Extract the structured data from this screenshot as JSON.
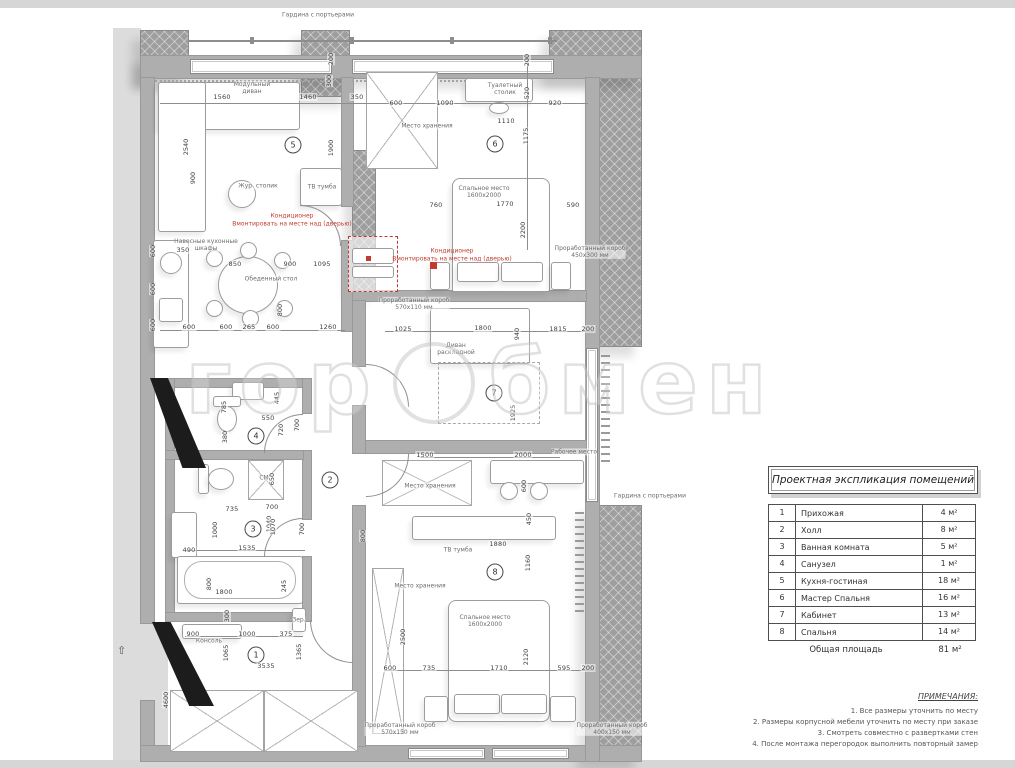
{
  "watermark": {
    "part1": "гор",
    "part2": "бмен"
  },
  "legend": {
    "title": "Проектная экспликация помещений",
    "rows": [
      {
        "num": "1",
        "name": "Прихожая",
        "area": "4 м²"
      },
      {
        "num": "2",
        "name": "Холл",
        "area": "8 м²"
      },
      {
        "num": "3",
        "name": "Ванная комната",
        "area": "5 м²"
      },
      {
        "num": "4",
        "name": "Санузел",
        "area": "1 м²"
      },
      {
        "num": "5",
        "name": "Кухня-гостиная",
        "area": "18 м²"
      },
      {
        "num": "6",
        "name": "Мастер Спальня",
        "area": "16 м²"
      },
      {
        "num": "7",
        "name": "Кабинет",
        "area": "13 м²"
      },
      {
        "num": "8",
        "name": "Спальня",
        "area": "14 м²"
      }
    ],
    "total_label": "Общая площадь",
    "total_area": "81 м²"
  },
  "notes": {
    "heading": "ПРИМЕЧАНИЯ:",
    "items": [
      "1. Все размеры уточнить по месту",
      "2. Размеры корпусной мебели уточнить по месту при заказе",
      "3. Смотреть совместно с развертками стен",
      "4. После монтажа перегородок выполнить повторный замер"
    ]
  },
  "plan": {
    "colors": {
      "wall": "#aeaeae",
      "hatch": "#9e9e9e",
      "dim_text": "#3f3f3f",
      "label_text": "#6c6c6c",
      "red": "#c23b2e"
    },
    "labels": [
      {
        "t": "Гардина с портьерами",
        "x": 318,
        "y": 15,
        "c": "name"
      },
      {
        "t": "Модульный\nдиван",
        "x": 252,
        "y": 88,
        "c": "name"
      },
      {
        "t": "Жур. столик",
        "x": 258,
        "y": 186,
        "c": "name"
      },
      {
        "t": "ТВ тумба",
        "x": 322,
        "y": 187,
        "c": "name"
      },
      {
        "t": "Туалетный\nстолик",
        "x": 505,
        "y": 89,
        "c": "name"
      },
      {
        "t": "Место хранения",
        "x": 427,
        "y": 126,
        "c": "name"
      },
      {
        "t": "Спальное место\n1600х2000",
        "x": 484,
        "y": 192,
        "c": "name"
      },
      {
        "t": "Навесные кухонные\nшкафы",
        "x": 206,
        "y": 245,
        "c": "name"
      },
      {
        "t": "Обеденный стол",
        "x": 271,
        "y": 279,
        "c": "name"
      },
      {
        "t": "Диван\nраскладной",
        "x": 456,
        "y": 349,
        "c": "name"
      },
      {
        "t": "Проработанный короб\n570х110 мм",
        "x": 414,
        "y": 304,
        "c": "name"
      },
      {
        "t": "Проработанный короб\n450х300 мм",
        "x": 590,
        "y": 252,
        "c": "name"
      },
      {
        "t": "Место хранения",
        "x": 430,
        "y": 486,
        "c": "name"
      },
      {
        "t": "Рабочее место",
        "x": 574,
        "y": 452,
        "c": "name"
      },
      {
        "t": "ТВ тумба",
        "x": 458,
        "y": 550,
        "c": "name"
      },
      {
        "t": "Место хранения",
        "x": 420,
        "y": 586,
        "c": "name"
      },
      {
        "t": "Спальное место\n1600х2000",
        "x": 485,
        "y": 621,
        "c": "name"
      },
      {
        "t": "Гардина с портьерами",
        "x": 650,
        "y": 496,
        "c": "name"
      },
      {
        "t": "Консоль",
        "x": 209,
        "y": 641,
        "c": "name"
      },
      {
        "t": "Зер.",
        "x": 299,
        "y": 620,
        "c": "name"
      },
      {
        "t": "СМ",
        "x": 264,
        "y": 478,
        "c": "name"
      },
      {
        "t": "Проработанный короб\n570х150 мм",
        "x": 400,
        "y": 729,
        "c": "name"
      },
      {
        "t": "Проработанный короб\n400х150 мм",
        "x": 612,
        "y": 729,
        "c": "name"
      },
      {
        "t": "Кондиционер\nВмонтировать на месте над (дверью)",
        "x": 292,
        "y": 220,
        "c": "red"
      },
      {
        "t": "Кондиционер\nВмонтировать на месте над (дверью)",
        "x": 452,
        "y": 255,
        "c": "red"
      },
      {
        "t": "5",
        "x": 293,
        "y": 145,
        "c": "circle"
      },
      {
        "t": "6",
        "x": 495,
        "y": 144,
        "c": "circle"
      },
      {
        "t": "7",
        "x": 494,
        "y": 393,
        "c": "circle"
      },
      {
        "t": "2",
        "x": 330,
        "y": 480,
        "c": "circle"
      },
      {
        "t": "4",
        "x": 256,
        "y": 436,
        "c": "circle"
      },
      {
        "t": "3",
        "x": 253,
        "y": 529,
        "c": "circle"
      },
      {
        "t": "8",
        "x": 495,
        "y": 572,
        "c": "circle"
      },
      {
        "t": "1",
        "x": 256,
        "y": 655,
        "c": "circle"
      },
      {
        "t": "1560",
        "x": 222,
        "y": 97,
        "c": "dim"
      },
      {
        "t": "1460",
        "x": 308,
        "y": 97,
        "c": "dim"
      },
      {
        "t": "350",
        "x": 357,
        "y": 97,
        "c": "dim"
      },
      {
        "t": "600",
        "x": 396,
        "y": 103,
        "c": "dim"
      },
      {
        "t": "1090",
        "x": 445,
        "y": 103,
        "c": "dim"
      },
      {
        "t": "920",
        "x": 555,
        "y": 103,
        "c": "dim"
      },
      {
        "t": "1110",
        "x": 506,
        "y": 121,
        "c": "dim"
      },
      {
        "t": "760",
        "x": 436,
        "y": 205,
        "c": "dim"
      },
      {
        "t": "1770",
        "x": 505,
        "y": 204,
        "c": "dim"
      },
      {
        "t": "590",
        "x": 573,
        "y": 205,
        "c": "dim"
      },
      {
        "t": "350",
        "x": 183,
        "y": 250,
        "c": "dim"
      },
      {
        "t": "850",
        "x": 235,
        "y": 264,
        "c": "dim"
      },
      {
        "t": "900",
        "x": 290,
        "y": 264,
        "c": "dim"
      },
      {
        "t": "1095",
        "x": 322,
        "y": 264,
        "c": "dim"
      },
      {
        "t": "600",
        "x": 189,
        "y": 327,
        "c": "dim"
      },
      {
        "t": "600",
        "x": 226,
        "y": 327,
        "c": "dim"
      },
      {
        "t": "265",
        "x": 249,
        "y": 327,
        "c": "dim"
      },
      {
        "t": "600",
        "x": 273,
        "y": 327,
        "c": "dim"
      },
      {
        "t": "1260",
        "x": 328,
        "y": 327,
        "c": "dim"
      },
      {
        "t": "1025",
        "x": 403,
        "y": 329,
        "c": "dim"
      },
      {
        "t": "1800",
        "x": 483,
        "y": 328,
        "c": "dim"
      },
      {
        "t": "1815",
        "x": 558,
        "y": 329,
        "c": "dim"
      },
      {
        "t": "200",
        "x": 588,
        "y": 329,
        "c": "dim"
      },
      {
        "t": "550",
        "x": 268,
        "y": 418,
        "c": "dim"
      },
      {
        "t": "735",
        "x": 232,
        "y": 509,
        "c": "dim"
      },
      {
        "t": "700",
        "x": 272,
        "y": 507,
        "c": "dim"
      },
      {
        "t": "490",
        "x": 189,
        "y": 550,
        "c": "dim"
      },
      {
        "t": "1535",
        "x": 247,
        "y": 548,
        "c": "dim"
      },
      {
        "t": "1800",
        "x": 224,
        "y": 592,
        "c": "dim"
      },
      {
        "t": "900",
        "x": 193,
        "y": 634,
        "c": "dim"
      },
      {
        "t": "1000",
        "x": 247,
        "y": 634,
        "c": "dim"
      },
      {
        "t": "375",
        "x": 286,
        "y": 634,
        "c": "dim"
      },
      {
        "t": "3535",
        "x": 266,
        "y": 666,
        "c": "dim"
      },
      {
        "t": "1500",
        "x": 425,
        "y": 455,
        "c": "dim"
      },
      {
        "t": "2000",
        "x": 523,
        "y": 455,
        "c": "dim"
      },
      {
        "t": "1880",
        "x": 498,
        "y": 544,
        "c": "dim"
      },
      {
        "t": "600",
        "x": 390,
        "y": 668,
        "c": "dim"
      },
      {
        "t": "735",
        "x": 429,
        "y": 668,
        "c": "dim"
      },
      {
        "t": "1710",
        "x": 499,
        "y": 668,
        "c": "dim"
      },
      {
        "t": "595",
        "x": 564,
        "y": 668,
        "c": "dim"
      },
      {
        "t": "200",
        "x": 588,
        "y": 668,
        "c": "dim"
      },
      {
        "t": "200",
        "x": 331,
        "y": 59,
        "c": "dimv"
      },
      {
        "t": "300",
        "x": 329,
        "y": 81,
        "c": "dimv"
      },
      {
        "t": "1900",
        "x": 331,
        "y": 148,
        "c": "dimv"
      },
      {
        "t": "2540",
        "x": 186,
        "y": 147,
        "c": "dimv"
      },
      {
        "t": "900",
        "x": 193,
        "y": 178,
        "c": "dimv"
      },
      {
        "t": "200",
        "x": 527,
        "y": 60,
        "c": "dimv"
      },
      {
        "t": "520",
        "x": 527,
        "y": 93,
        "c": "dimv"
      },
      {
        "t": "1175",
        "x": 526,
        "y": 136,
        "c": "dimv"
      },
      {
        "t": "2200",
        "x": 523,
        "y": 230,
        "c": "dimv"
      },
      {
        "t": "600",
        "x": 153,
        "y": 251,
        "c": "dimv"
      },
      {
        "t": "600",
        "x": 153,
        "y": 289,
        "c": "dimv"
      },
      {
        "t": "600",
        "x": 153,
        "y": 325,
        "c": "dimv"
      },
      {
        "t": "800",
        "x": 280,
        "y": 310,
        "c": "dimv"
      },
      {
        "t": "940",
        "x": 517,
        "y": 334,
        "c": "dimv"
      },
      {
        "t": "1925",
        "x": 513,
        "y": 413,
        "c": "dimv"
      },
      {
        "t": "785",
        "x": 224,
        "y": 407,
        "c": "dimv"
      },
      {
        "t": "445",
        "x": 277,
        "y": 398,
        "c": "dimv"
      },
      {
        "t": "380",
        "x": 225,
        "y": 437,
        "c": "dimv"
      },
      {
        "t": "720",
        "x": 281,
        "y": 430,
        "c": "dimv"
      },
      {
        "t": "700",
        "x": 297,
        "y": 425,
        "c": "dimv"
      },
      {
        "t": "650",
        "x": 272,
        "y": 479,
        "c": "dimv"
      },
      {
        "t": "1040",
        "x": 269,
        "y": 524,
        "c": "dimv"
      },
      {
        "t": "1000",
        "x": 215,
        "y": 530,
        "c": "dimv"
      },
      {
        "t": "1070",
        "x": 273,
        "y": 527,
        "c": "dimv"
      },
      {
        "t": "700",
        "x": 302,
        "y": 529,
        "c": "dimv"
      },
      {
        "t": "800",
        "x": 209,
        "y": 584,
        "c": "dimv"
      },
      {
        "t": "245",
        "x": 284,
        "y": 586,
        "c": "dimv"
      },
      {
        "t": "300",
        "x": 227,
        "y": 616,
        "c": "dimv"
      },
      {
        "t": "1065",
        "x": 226,
        "y": 653,
        "c": "dimv"
      },
      {
        "t": "1365",
        "x": 299,
        "y": 652,
        "c": "dimv"
      },
      {
        "t": "800",
        "x": 363,
        "y": 536,
        "c": "dimv"
      },
      {
        "t": "600",
        "x": 524,
        "y": 486,
        "c": "dimv"
      },
      {
        "t": "450",
        "x": 529,
        "y": 519,
        "c": "dimv"
      },
      {
        "t": "1160",
        "x": 528,
        "y": 563,
        "c": "dimv"
      },
      {
        "t": "2500",
        "x": 403,
        "y": 637,
        "c": "dimv"
      },
      {
        "t": "2120",
        "x": 526,
        "y": 657,
        "c": "dimv"
      },
      {
        "t": "4600",
        "x": 166,
        "y": 700,
        "c": "dimv"
      }
    ]
  }
}
